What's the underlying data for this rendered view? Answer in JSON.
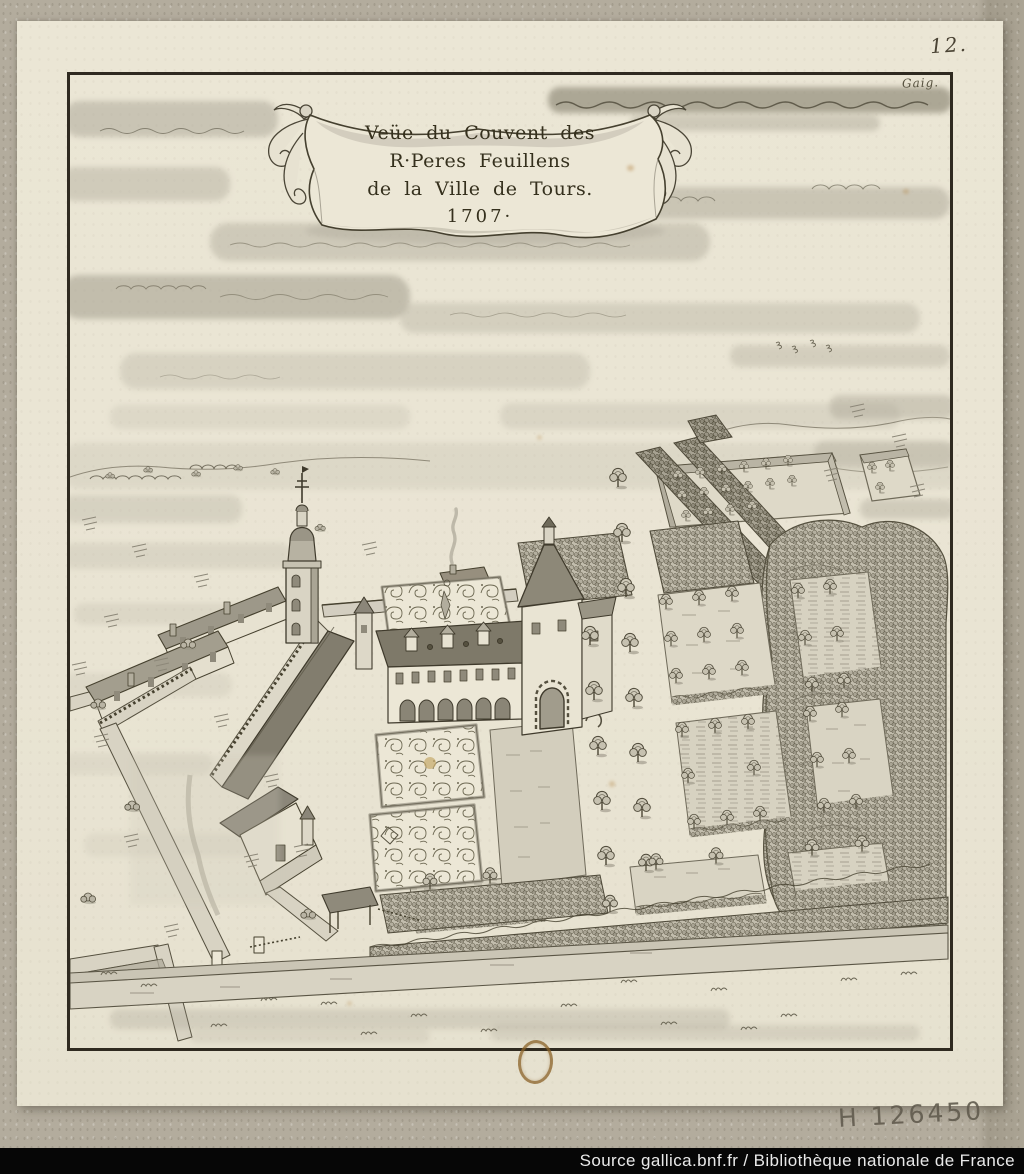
{
  "cartouche": {
    "line1": "Veüe du Couvent des",
    "line2": "R·Peres Feuillens",
    "line3": "de la Ville de Tours.",
    "line4": "1707·"
  },
  "annotations": {
    "page_number": "12.",
    "collection_mark": "Gaig.",
    "shelfmark": "H 126450"
  },
  "footer": {
    "credit": "Source gallica.bnf.fr / Bibliothèque nationale de France"
  },
  "colors": {
    "mat": "#b3ac9d",
    "paper": "#e9e4d3",
    "ink": "#35301d",
    "wash_light": "#c9c4b4",
    "wash_dark": "#8d8879",
    "footer_bar": "#060606",
    "footer_text": "#e9e9e9",
    "seal_mark": "#8a6227"
  }
}
